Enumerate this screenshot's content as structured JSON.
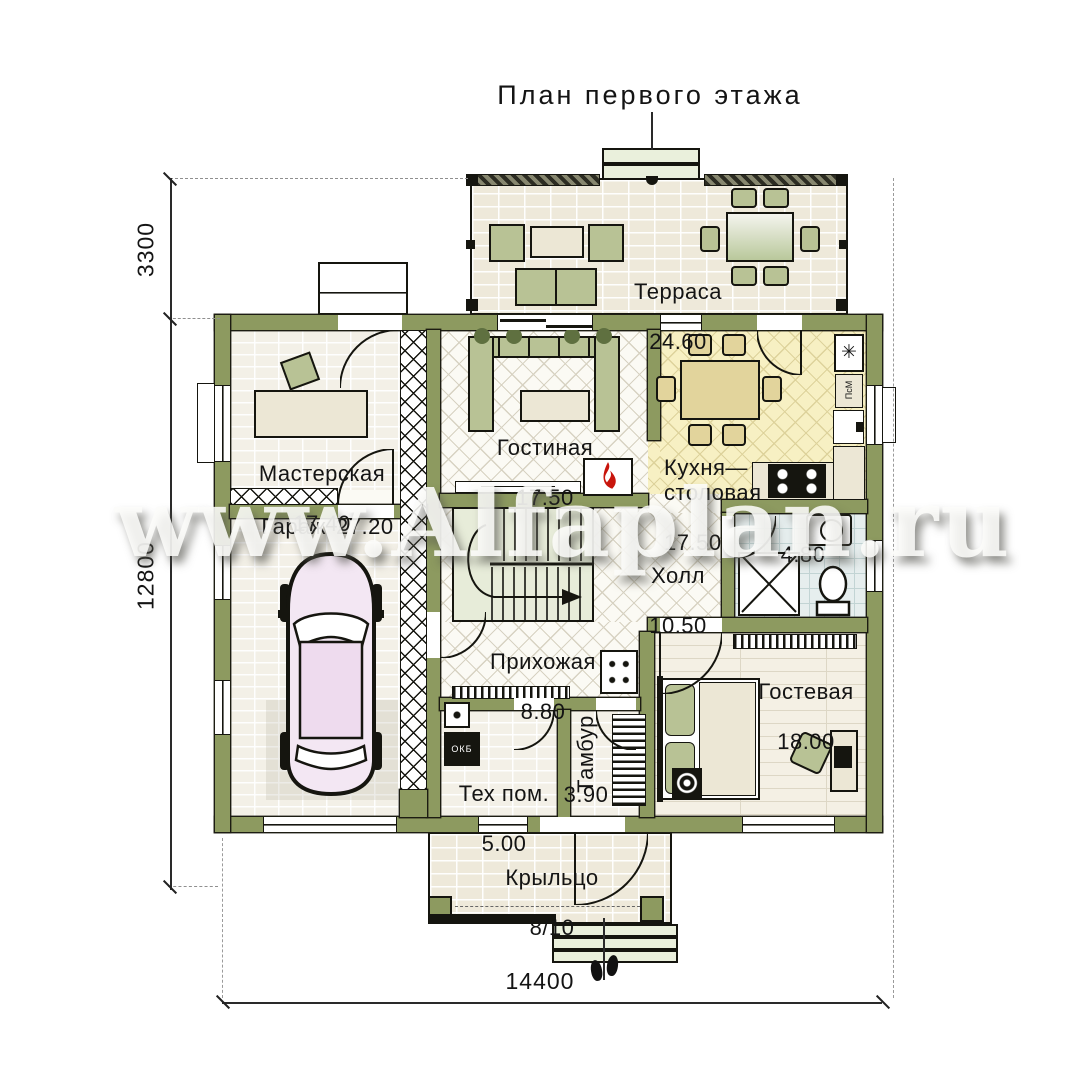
{
  "title": "План первого этажа",
  "watermark": "www.Alfaplan.ru",
  "dimensions": {
    "left_top": "3300",
    "left_total": "12800",
    "bottom_width": "14400"
  },
  "rooms": {
    "terrace": {
      "name": "Терраса",
      "area": "24.60"
    },
    "living": {
      "name": "Гостиная",
      "area": "17.50"
    },
    "kitchen": {
      "name": "Кухня—\nстоловая",
      "area": "17.50"
    },
    "workshop": {
      "name": "Мастерская",
      "area": "17.40"
    },
    "garage": {
      "name": "Гараж",
      "area": "27.20"
    },
    "hall": {
      "name": "Холл",
      "area": "10.50"
    },
    "entry": {
      "name": "Прихожая",
      "area": "8.80"
    },
    "guest": {
      "name": "Гостевая",
      "area": "18.00"
    },
    "tech": {
      "name": "Тех пом.",
      "area": "5.00"
    },
    "tambour": {
      "name": "Тамбур",
      "area": "3.90"
    },
    "bathroom": {
      "area": "4.80"
    },
    "porch": {
      "name": "Крыльцо",
      "area": "8/10"
    }
  },
  "equipment": {
    "boiler": "ОКБ",
    "dishwasher": "ПсМ",
    "fridge_symbol": "✳"
  },
  "colors": {
    "wall": "#8d9a60",
    "kitchen_floor": "#f7f0c3",
    "flame": "#c8150c"
  }
}
